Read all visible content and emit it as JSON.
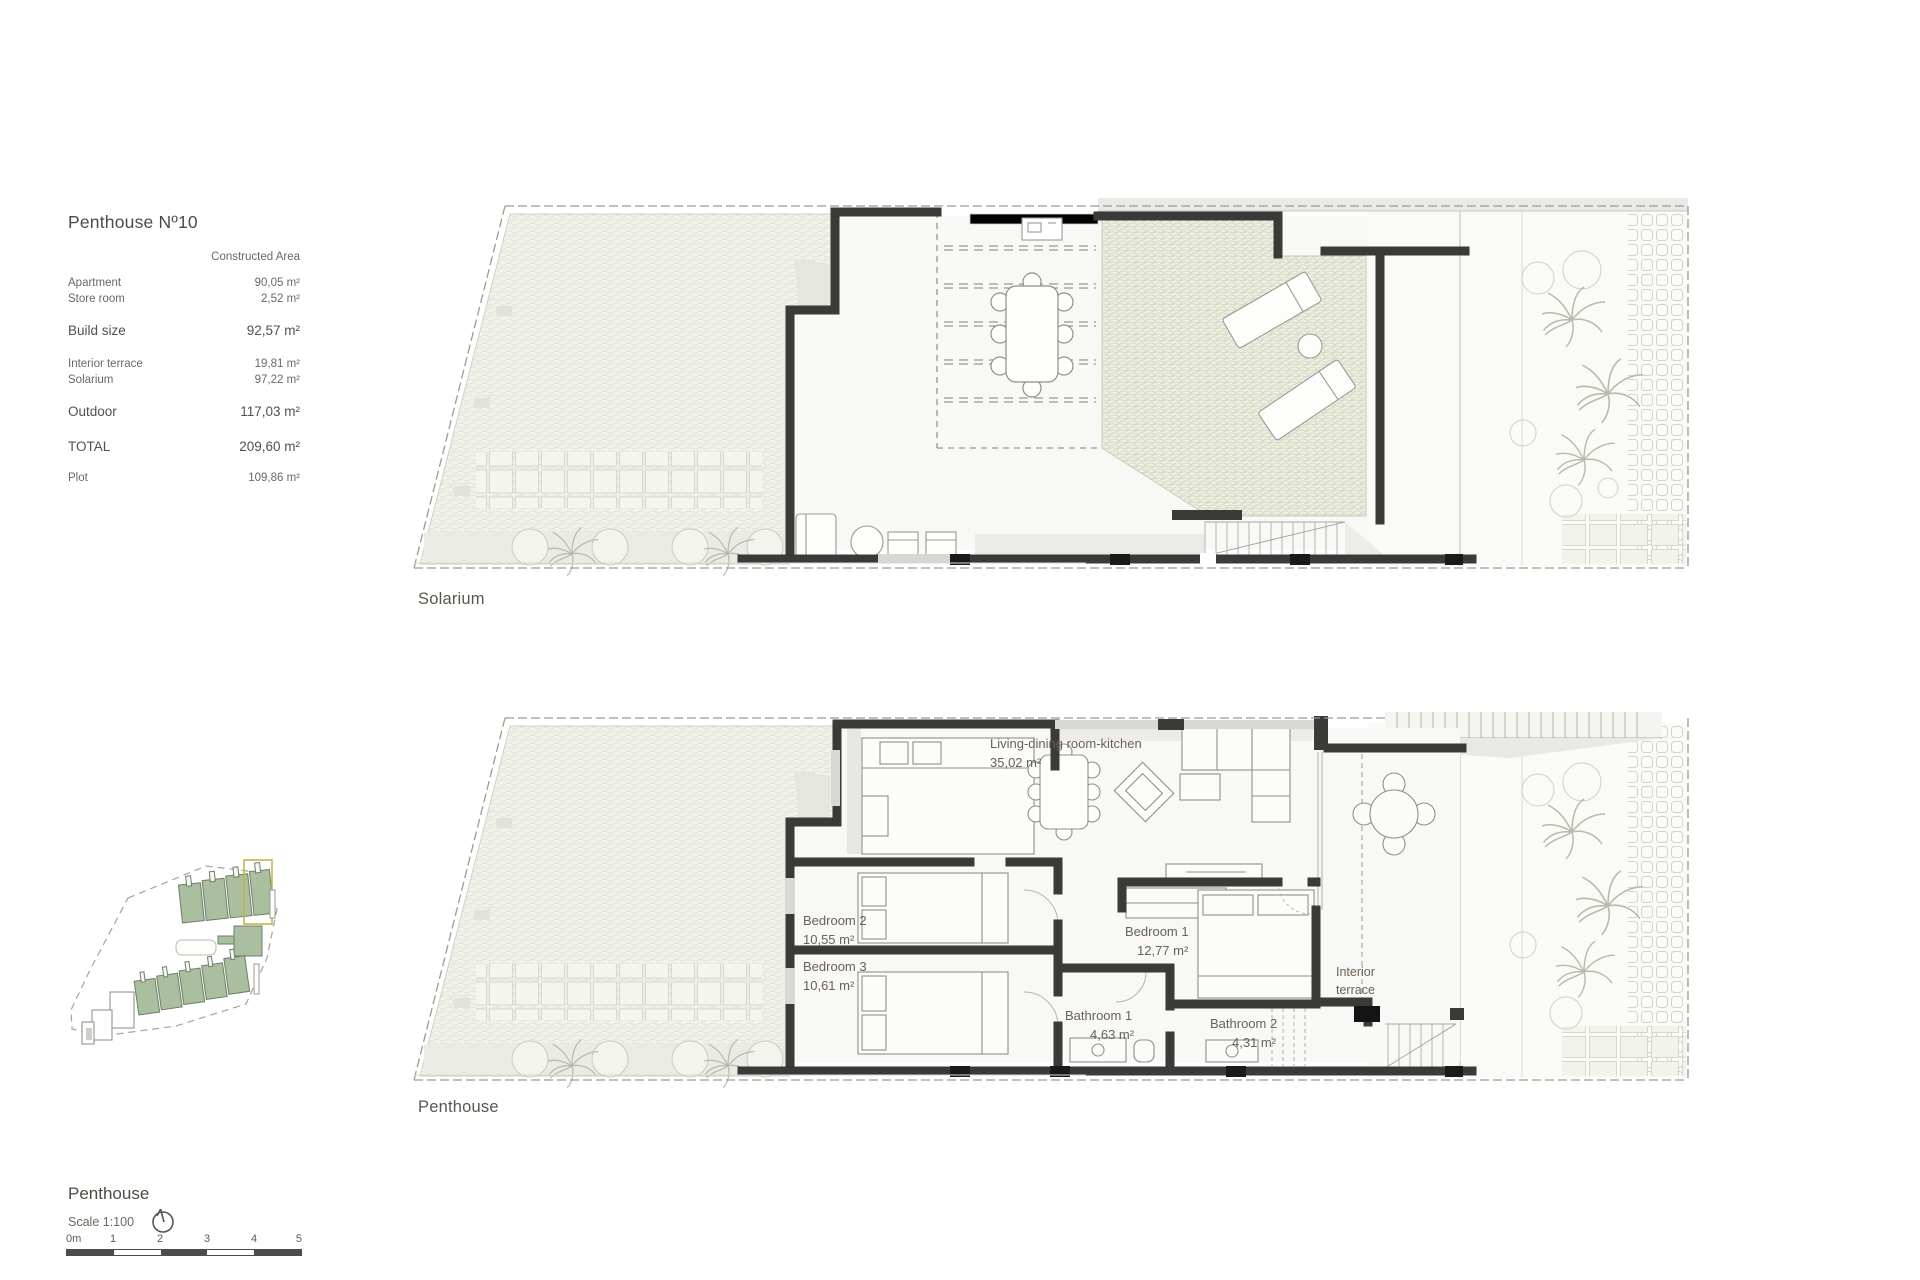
{
  "info_panel": {
    "title": "Penthouse Nº10",
    "column_header": "Constructed Area",
    "rows": [
      {
        "label": "Apartment",
        "value": "90,05 m²"
      },
      {
        "label": "Store room",
        "value": "2,52 m²"
      },
      {
        "label": "Build size",
        "value": "92,57 m²"
      },
      {
        "label": "Interior terrace",
        "value": "19,81 m²"
      },
      {
        "label": "Solarium",
        "value": "97,22 m²"
      },
      {
        "label": "Outdoor",
        "value": "117,03 m²"
      },
      {
        "label": "TOTAL",
        "value": "209,60 m²"
      },
      {
        "label": "Plot",
        "value": "109,86 m²"
      }
    ]
  },
  "plans": {
    "solarium": {
      "caption": "Solarium"
    },
    "penthouse": {
      "caption": "Penthouse",
      "rooms": {
        "living": {
          "name": "Living-dining room-kitchen",
          "area": "35,02 m²"
        },
        "bedroom2": {
          "name": "Bedroom 2",
          "area": "10,55 m²"
        },
        "bedroom3": {
          "name": "Bedroom 3",
          "area": "10,61 m²"
        },
        "bedroom1": {
          "name": "Bedroom 1",
          "area": "12,77 m²"
        },
        "bathroom1": {
          "name": "Bathroom 1",
          "area": "4,63 m²"
        },
        "bathroom2": {
          "name": "Bathroom 2",
          "area": "4,31 m²"
        },
        "interior_terrace": {
          "line1": "Interior",
          "line2": "terrace"
        }
      }
    }
  },
  "footer": {
    "floor_title": "Penthouse",
    "scale_label": "Scale 1:100",
    "scale_ticks": [
      "0m",
      "1",
      "2",
      "3",
      "4",
      "5"
    ]
  },
  "colors": {
    "wall": "#3a3a38",
    "label_text": "#6b6156",
    "building_green": "#aabfa0",
    "highlight_yellow": "#c9b44a",
    "scale_bar_dark": "#4c4c48"
  }
}
